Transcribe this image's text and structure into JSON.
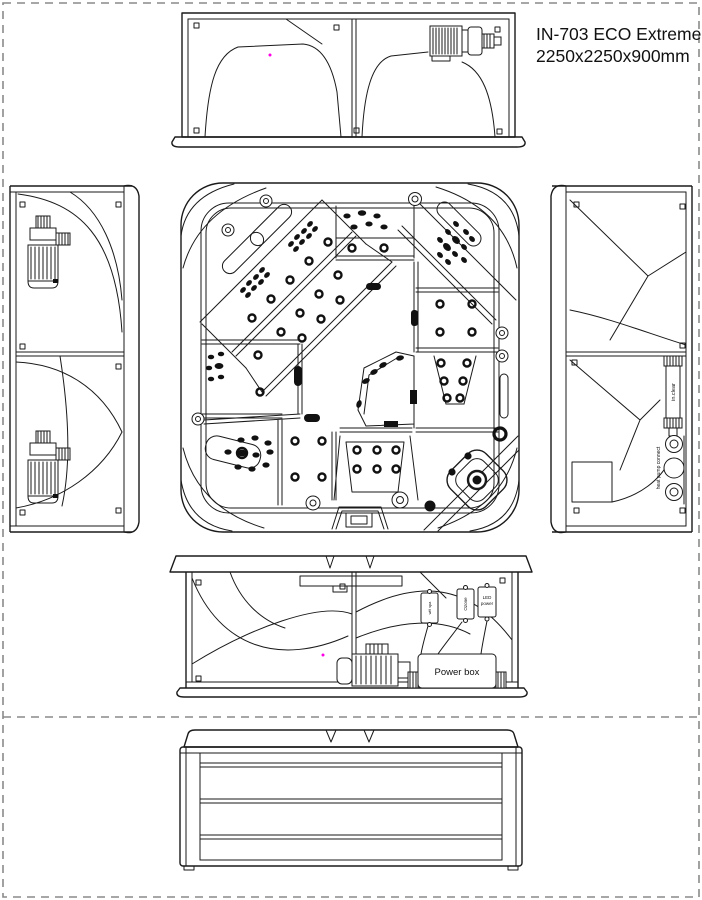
{
  "title": {
    "model": "IN-703 ECO Extreme",
    "dimensions": "2250x2250x900mm"
  },
  "colors": {
    "line": "#1a1a1a",
    "page_border": "#8a8a8a",
    "marker_dot": "#ff00e6",
    "background": "#ffffff"
  },
  "equipment_labels": {
    "power_box": "Power box",
    "ozone": "Ozone",
    "led_line1": "LED",
    "led_line2": "power",
    "wifi_spa": "wifi spa",
    "in_clear": "in.clear",
    "heat_pump_connect": "heat pump connect"
  }
}
